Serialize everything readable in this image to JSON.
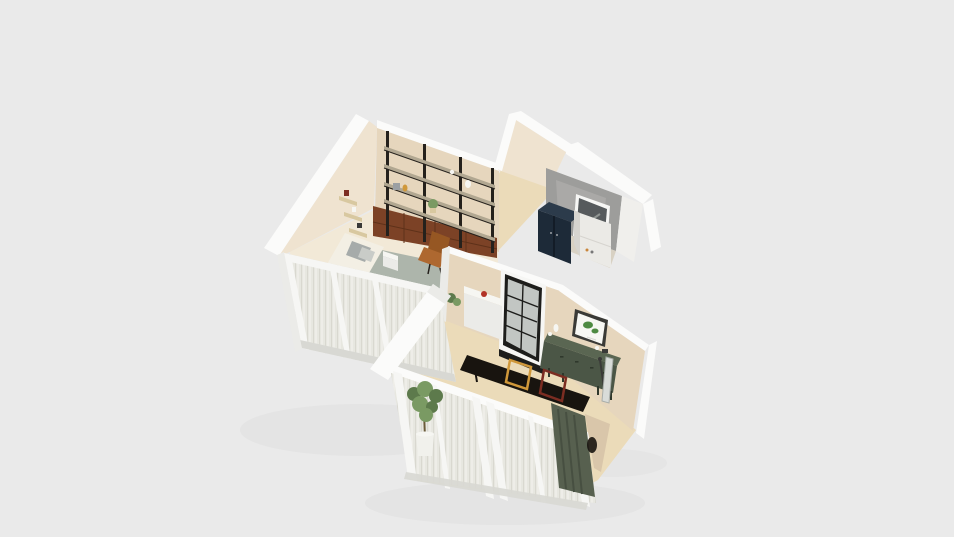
{
  "scene": {
    "type": "3d-floorplan-isometric-render",
    "rooms": [
      {
        "name": "study-bedroom",
        "objects": [
          "wall-shelving-unit",
          "wood-drawer-cabinets",
          "corner-wall-shelves",
          "leather-desk-chair",
          "bed",
          "area-rug",
          "wood-bench",
          "bedside-table",
          "sheer-curtain-windows"
        ]
      },
      {
        "name": "laundry-bathroom",
        "objects": [
          "concrete-wall",
          "navy-cabinet",
          "white-appliance",
          "window"
        ]
      },
      {
        "name": "kitchen-dining",
        "objects": [
          "glass-panel-door",
          "kitchen-counter",
          "floor-plant",
          "dining-table",
          "orange-chair",
          "red-chair",
          "green-sideboard",
          "botanical-art",
          "leaning-mirror",
          "floor-lamp",
          "green-curtain",
          "tall-potted-plant",
          "sheer-curtain-windows"
        ]
      }
    ]
  },
  "colors": {
    "bg": "#eaeaea",
    "shadow": "#dddddd",
    "white_wall": "#fbfbfa",
    "white_shade": "#ebebe8",
    "beige_light": "#efe3d0",
    "beige": "#e6d6bd",
    "beige_dark": "#d9c6aa",
    "floor_light": "#f2e9d7",
    "floor_tan": "#ebdbb9",
    "floor_gray": "#d8d1c3",
    "gray_wall": "#9d9d9b",
    "gray_wall_light": "#b7b6b3",
    "white_interior": "#f0efec",
    "frame_white": "#f6f6f4",
    "frame_gray": "#d8d8d3",
    "glass": "#e1e1da",
    "door_black": "#1d1d1b",
    "door_glass": "#c2c6c3",
    "navy": "#1d2a38",
    "navy_top": "#2c3b4b",
    "navy_dark": "#0d141c",
    "appliance": "#ebeae6",
    "appliance_shade": "#d6d4cf",
    "shelf_black": "#25211c",
    "shelf_board": "#b1a791",
    "drawer_wood": "#7c4226",
    "drawer_line": "#5e3119",
    "wood_light": "#d8c8a0",
    "bed_white": "#f3efe4",
    "duvet": "#ebe4d3",
    "pillow_a": "#a6abaa",
    "pillow_b": "#c9ccc8",
    "rug": "#a9b2a9",
    "leather": "#ae6830",
    "leather_dark": "#965723",
    "table_black": "#18140f",
    "chair_orange": "#d0983a",
    "chair_red": "#7c2d22",
    "sideboard": "#4b5646",
    "sideboard_top": "#5a6652",
    "sideboard_dark": "#2f382c",
    "curtain_green": "#57604f",
    "curtain_green_dark": "#474f41",
    "sheer_base": "#e9e8e1",
    "sheer_dark": "#d7d6cd",
    "sheer_light": "#f6f6f2",
    "plant": "#7a9a63",
    "plant_dark": "#5d7a4c",
    "pot": "#f1f1ec",
    "trunk": "#6b5b3a",
    "art_frame": "#3a3a36",
    "art_mat": "#f7f7f3",
    "art_green": "#4e8a42",
    "red_item": "#b23327",
    "white_decor": "#f6f6f2",
    "dark_decor": "#3a3a38",
    "gray_decor": "#9b9fa3",
    "window_pane_dark": "#565a5c",
    "metal_gray": "#a9aeaa",
    "mirror": "#d9dcd9",
    "detail_orange": "#c9863c",
    "detail_gray": "#777777"
  }
}
